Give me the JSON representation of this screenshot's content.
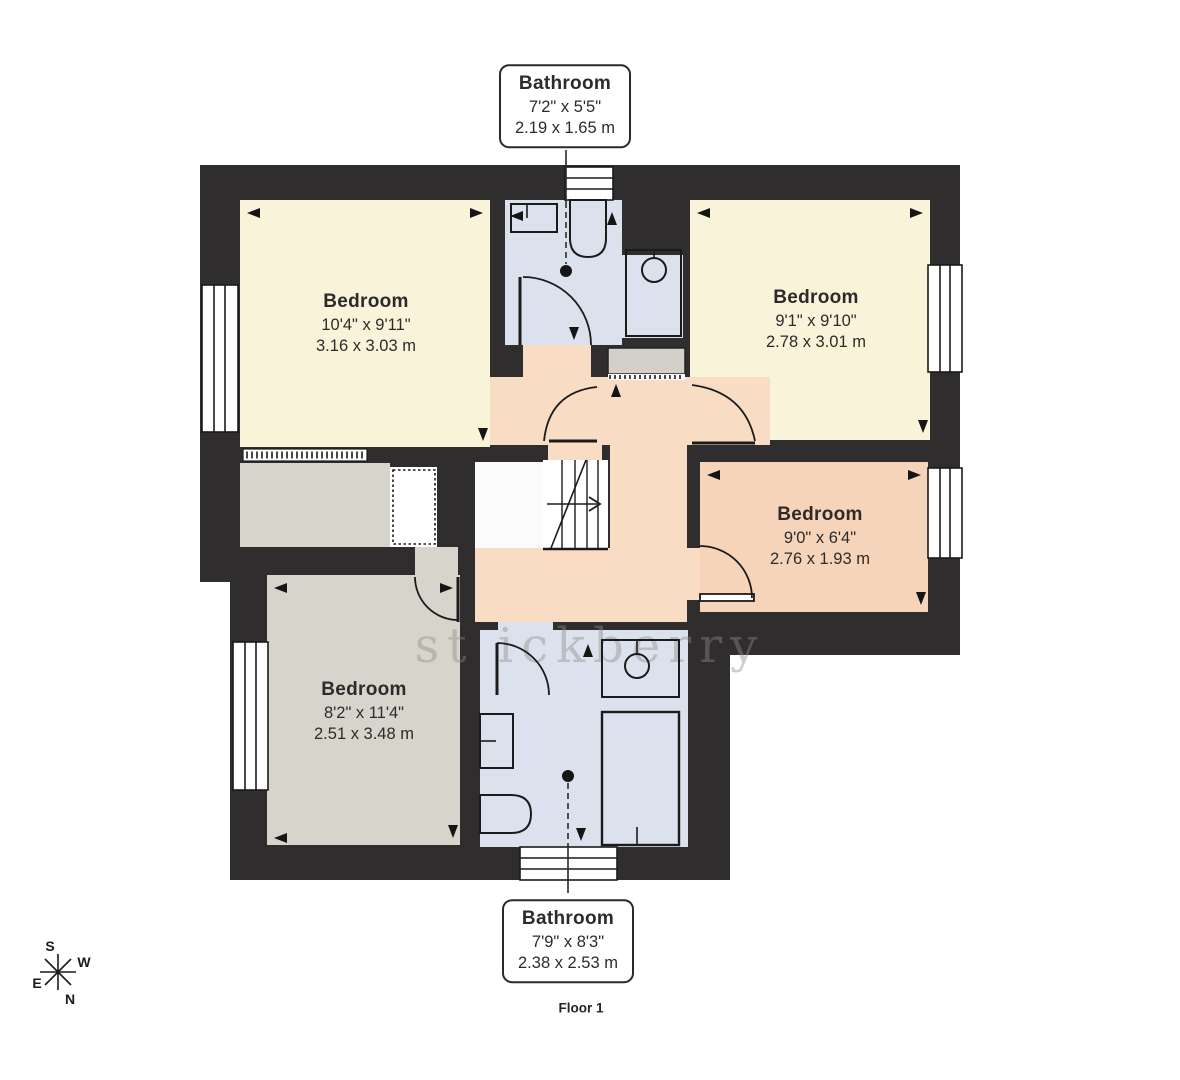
{
  "plan": {
    "floor_label": "Floor 1",
    "watermark": "st ickberry",
    "compass": {
      "n": "N",
      "s": "S",
      "e": "E",
      "w": "W"
    },
    "colors": {
      "wall": "#2f2d2e",
      "bedroom_cream": "#f9f3da",
      "bedroom_peach": "#f6d4ba",
      "bedroom_grey": "#d7d4cc",
      "bathroom_blue": "#dbe2ee",
      "landing_peach": "#f8dcc4"
    },
    "callouts": [
      {
        "id": "bathroom-top",
        "name": "Bathroom",
        "imperial": "7'2\" x 5'5\"",
        "metric": "2.19 x 1.65 m"
      },
      {
        "id": "bathroom-bottom",
        "name": "Bathroom",
        "imperial": "7'9\" x 8'3\"",
        "metric": "2.38 x 2.53 m"
      }
    ],
    "rooms": [
      {
        "id": "bedroom-top-left",
        "name": "Bedroom",
        "imperial": "10'4\" x 9'11\"",
        "metric": "3.16 x 3.03 m"
      },
      {
        "id": "bedroom-top-right",
        "name": "Bedroom",
        "imperial": "9'1\" x 9'10\"",
        "metric": "2.78 x 3.01 m"
      },
      {
        "id": "bedroom-mid-right",
        "name": "Bedroom",
        "imperial": "9'0\" x 6'4\"",
        "metric": "2.76 x 1.93 m"
      },
      {
        "id": "bedroom-bottom-left",
        "name": "Bedroom",
        "imperial": "8'2\" x 11'4\"",
        "metric": "2.51 x 3.48 m"
      }
    ]
  }
}
